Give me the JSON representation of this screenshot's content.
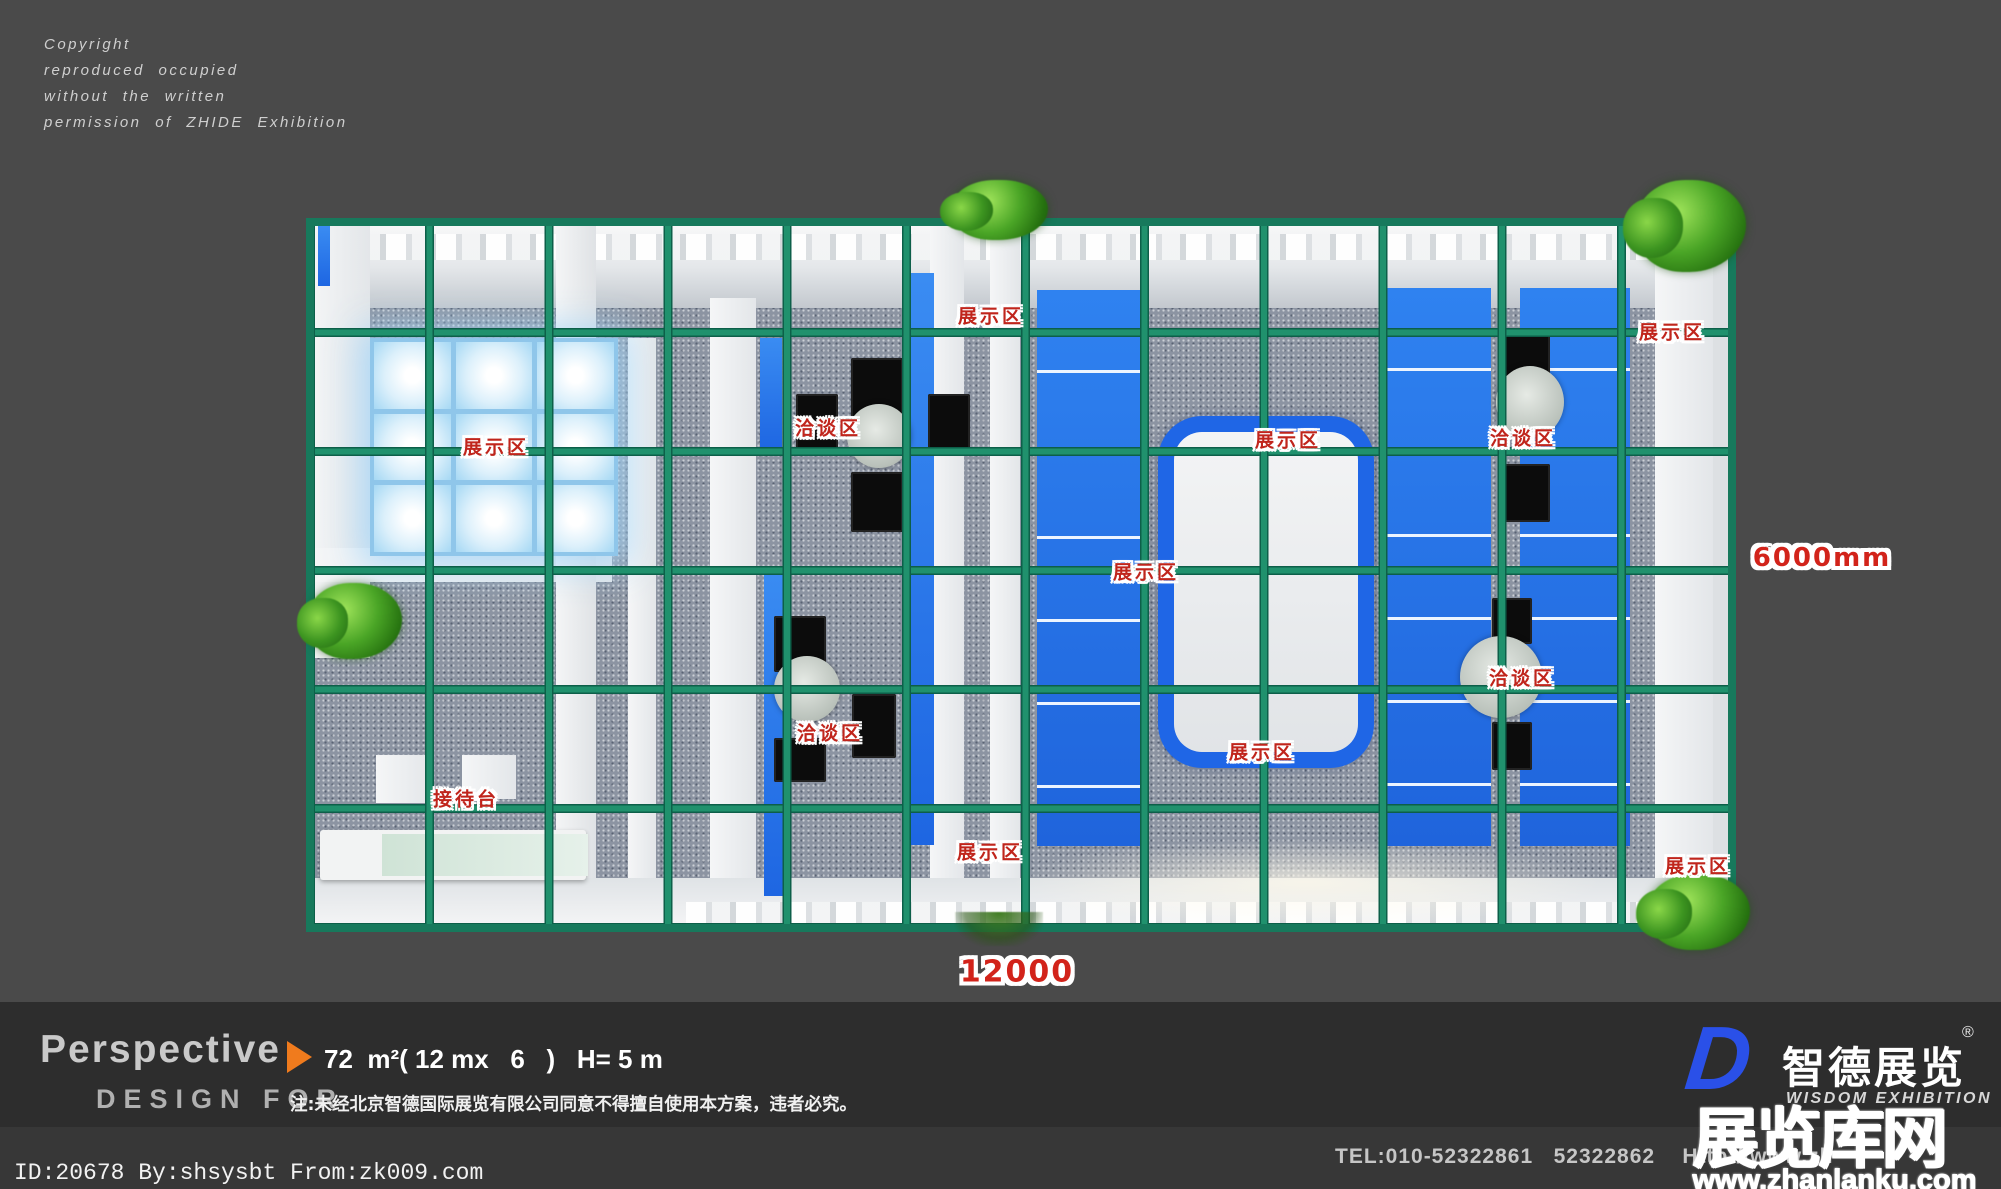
{
  "copyright": {
    "lines": [
      "Copyright",
      "reproduced occupied",
      "without the written",
      "permission of ZHIDE Exhibition"
    ]
  },
  "plan": {
    "labels": [
      {
        "text": "展示区",
        "x": 496,
        "y": 446
      },
      {
        "text": "洽谈区",
        "x": 828,
        "y": 427
      },
      {
        "text": "展示区",
        "x": 991,
        "y": 315
      },
      {
        "text": "展示区",
        "x": 1288,
        "y": 439
      },
      {
        "text": "洽谈区",
        "x": 1523,
        "y": 437
      },
      {
        "text": "展示区",
        "x": 1672,
        "y": 331
      },
      {
        "text": "展示区",
        "x": 1146,
        "y": 571
      },
      {
        "text": "洽谈区",
        "x": 1522,
        "y": 677
      },
      {
        "text": "展示区",
        "x": 1262,
        "y": 751
      },
      {
        "text": "洽谈区",
        "x": 830,
        "y": 732
      },
      {
        "text": "接待台",
        "x": 466,
        "y": 798
      },
      {
        "text": "展示区",
        "x": 990,
        "y": 851
      },
      {
        "text": "展示区",
        "x": 1698,
        "y": 865
      }
    ],
    "dimensions": {
      "width_label": "12000",
      "height_label": "6000mm"
    }
  },
  "footer": {
    "title": "Perspective",
    "spec": "72  m²( 12 mx   6   )   H= 5 m",
    "design_for": "DESIGN FOR",
    "note": "注:未经北京智德国际展览有限公司同意不得擅自使用本方案，违者必究。",
    "logo": {
      "d": "D",
      "name": "智德展览",
      "reg": "®",
      "subtitle": "WISDOM EXHIBITION"
    }
  },
  "bottom": {
    "tel": "TEL:010-52322861   52322862",
    "url": "    Http://www.zh",
    "id_line": "ID:20678 By:shsysbt From:zk009.com"
  },
  "watermark": {
    "text": "展览库网",
    "url": "www.zhanlanku.com"
  },
  "colors": {
    "grid_green": "#20916d",
    "panel_blue": "#2270ee",
    "label_red": "#c0251c",
    "logo_blue": "#2a50e8",
    "accent_orange": "#f07b1d"
  }
}
